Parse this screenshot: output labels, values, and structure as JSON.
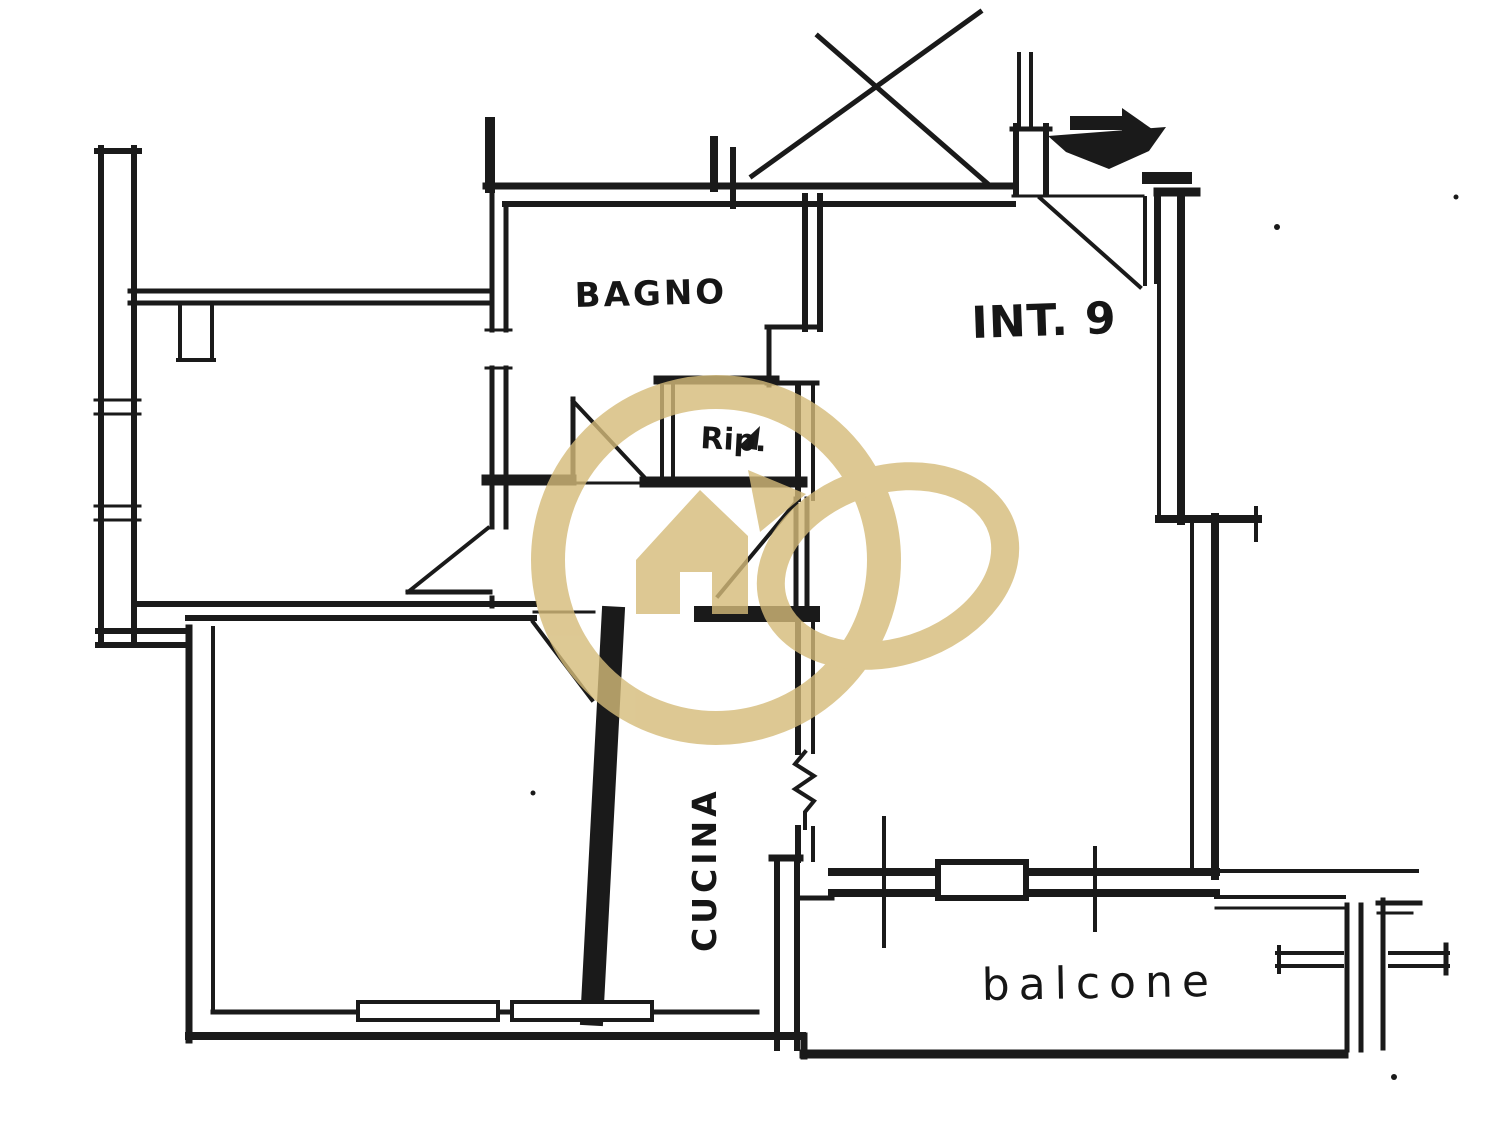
{
  "plan": {
    "unit_label": "INT. 9",
    "labels": {
      "bathroom": "BAGNO",
      "storage": "Rip.",
      "kitchen": "CUCINA",
      "balcony": "balcone"
    },
    "watermark": {
      "color": "#d5bb79",
      "description": "agency logo: circle with house-arrow and tilted ellipse"
    },
    "ink_color": "#1a1a1a",
    "background_color": "#ffffff",
    "symbols": [
      "cross-out-lines",
      "entrance-arrow",
      "door-swing",
      "window",
      "wall-break-squiggle",
      "balcony-railing"
    ]
  }
}
